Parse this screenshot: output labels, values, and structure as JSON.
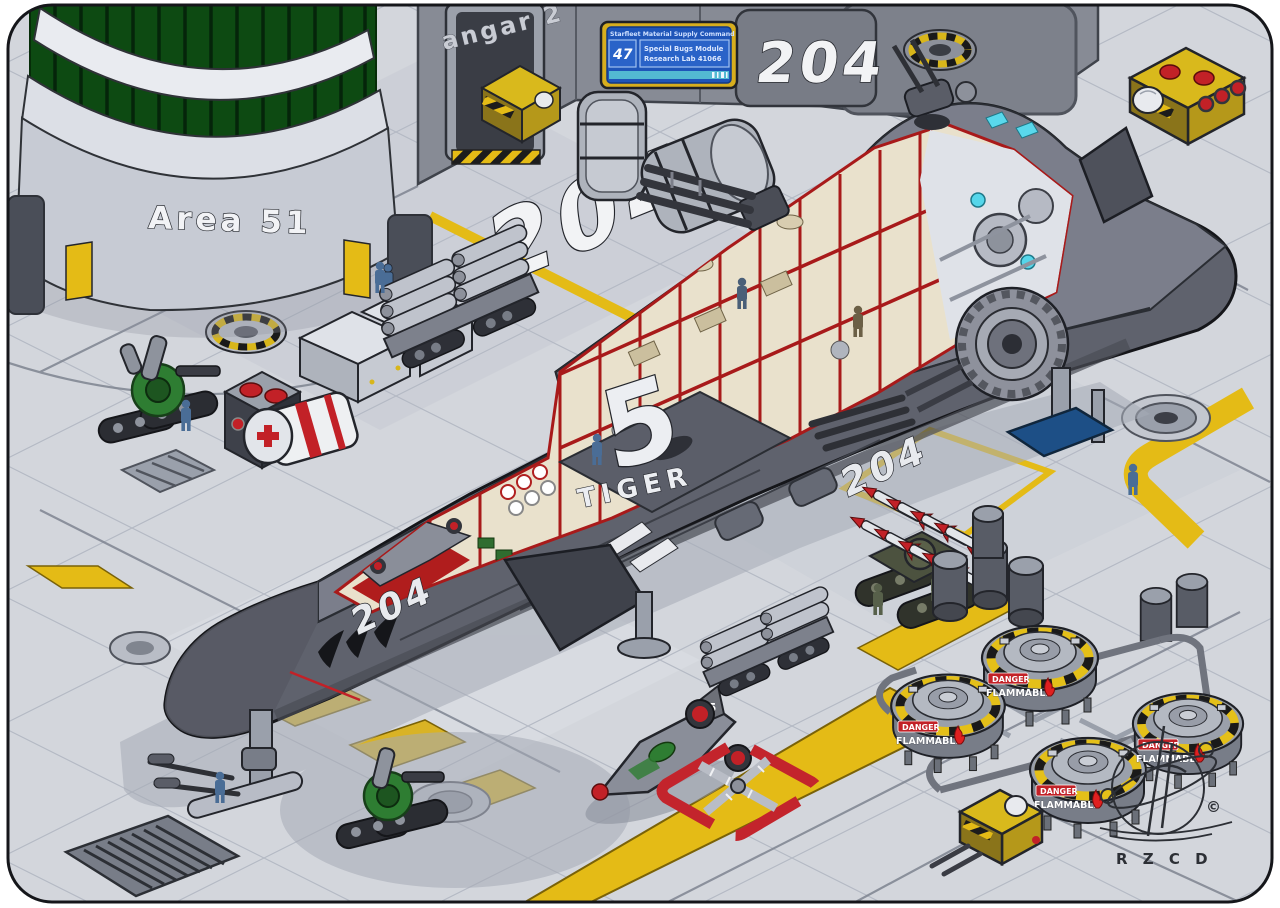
{
  "scene": {
    "building_name": "Area 51",
    "hangar_wall_text": "angar 2",
    "wall_door_number": "204",
    "floor_bay_number": "204",
    "signature_initials": "R Z C D",
    "copyright_symbol": "©"
  },
  "info_screen": {
    "header": "Starfleet Material Supply Command",
    "bay_code": "47",
    "line1": "Special Bugs Module",
    "line2": "Research Lab 41066"
  },
  "ship": {
    "class_name": "TIGER",
    "hull_number": "5",
    "registry_front": "204",
    "registry_rear": "204"
  },
  "fighter": {
    "tail_number": "5"
  },
  "fuel_depot": {
    "danger_label": "DANGER",
    "flammable_label": "FLAMMABLE"
  },
  "colors": {
    "floor": "#d3d6dc",
    "hull": "#70737f",
    "hull_dark": "#5f626d",
    "accent_yellow": "#e4bb16",
    "interior_cream": "#e9e1cc",
    "frame_red": "#a81a1a",
    "glass_green": "#0d4a12",
    "danger_red": "#c22127",
    "screen_blue": "#1f55b8"
  }
}
